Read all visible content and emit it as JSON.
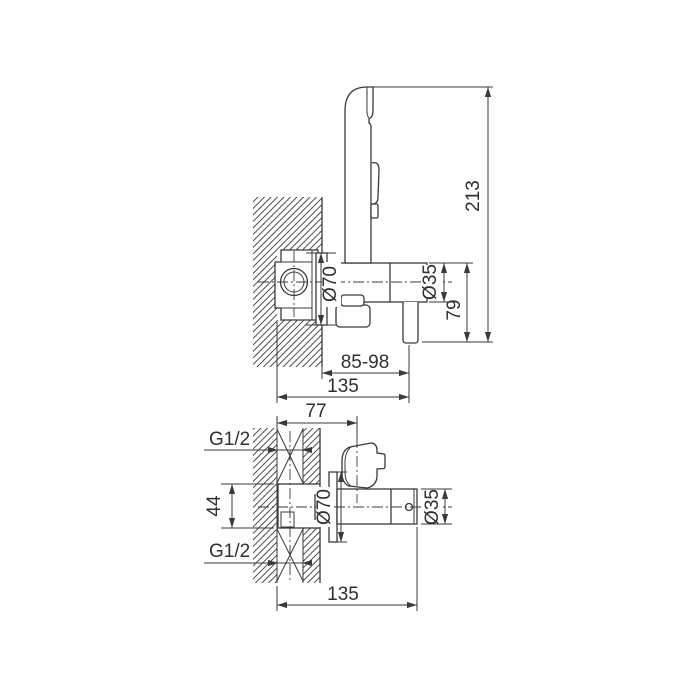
{
  "colors": {
    "line": "#3a3a3a",
    "background": "#ffffff"
  },
  "side_view": {
    "dim_height": "213",
    "dim_spout_drop": "79",
    "dim_body_diameter": "Ø35",
    "dim_escutcheon_diameter": "Ø70",
    "dim_wall_to_spout": "85-98",
    "dim_total_reach": "135"
  },
  "plan_view": {
    "dim_recess_to_holder": "77",
    "thread_top": "G1/2",
    "thread_bottom": "G1/2",
    "dim_port_spacing": "44",
    "dim_escutcheon_diameter": "Ø70",
    "dim_body_diameter": "Ø35",
    "dim_total_reach": "135"
  }
}
